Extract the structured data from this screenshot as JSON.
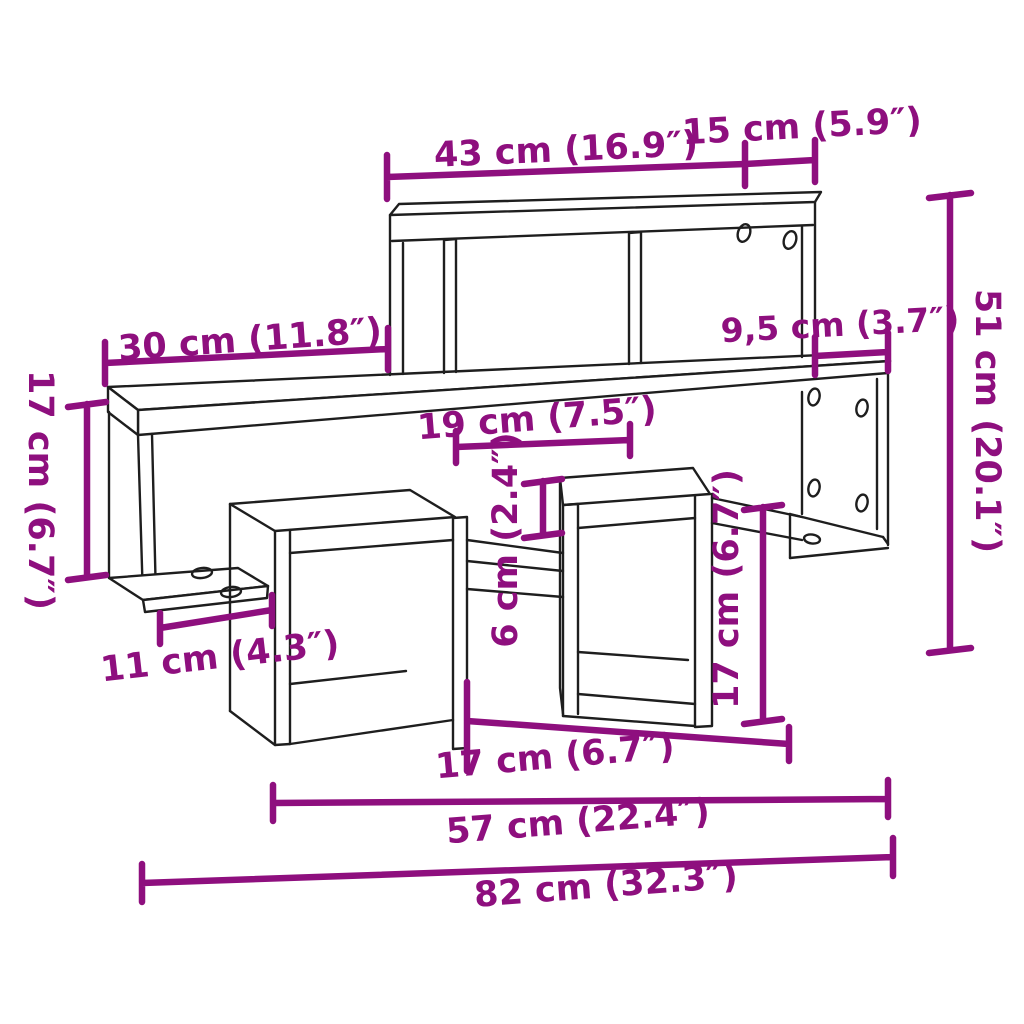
{
  "diagram": {
    "type": "furniture-dimension-diagram",
    "subject": "wall shelf with cube compartments",
    "colors": {
      "dimension_accent": "#8E0F7E",
      "line_art": "#1e1e1e",
      "background": "#ffffff"
    }
  },
  "dims": {
    "top_width": "43 cm (16.9″)",
    "top_depth": "15 cm (5.9″)",
    "left_section_width": "30 cm (11.8″)",
    "right_overhang": "9,5 cm (3.7″)",
    "total_height": "51 cm (20.1″)",
    "left_panel_height": "17 cm (6.7″)",
    "middle_shelf_depth": "19 cm (7.5″)",
    "slot_height": "6 cm (2.4″)",
    "cube_height": "17 cm (6.7″)",
    "foot_length": "11 cm (4.3″)",
    "cube_span": "17 cm (6.7″)",
    "lower_span": "57 cm (22.4″)",
    "total_width": "82 cm (32.3″)"
  }
}
